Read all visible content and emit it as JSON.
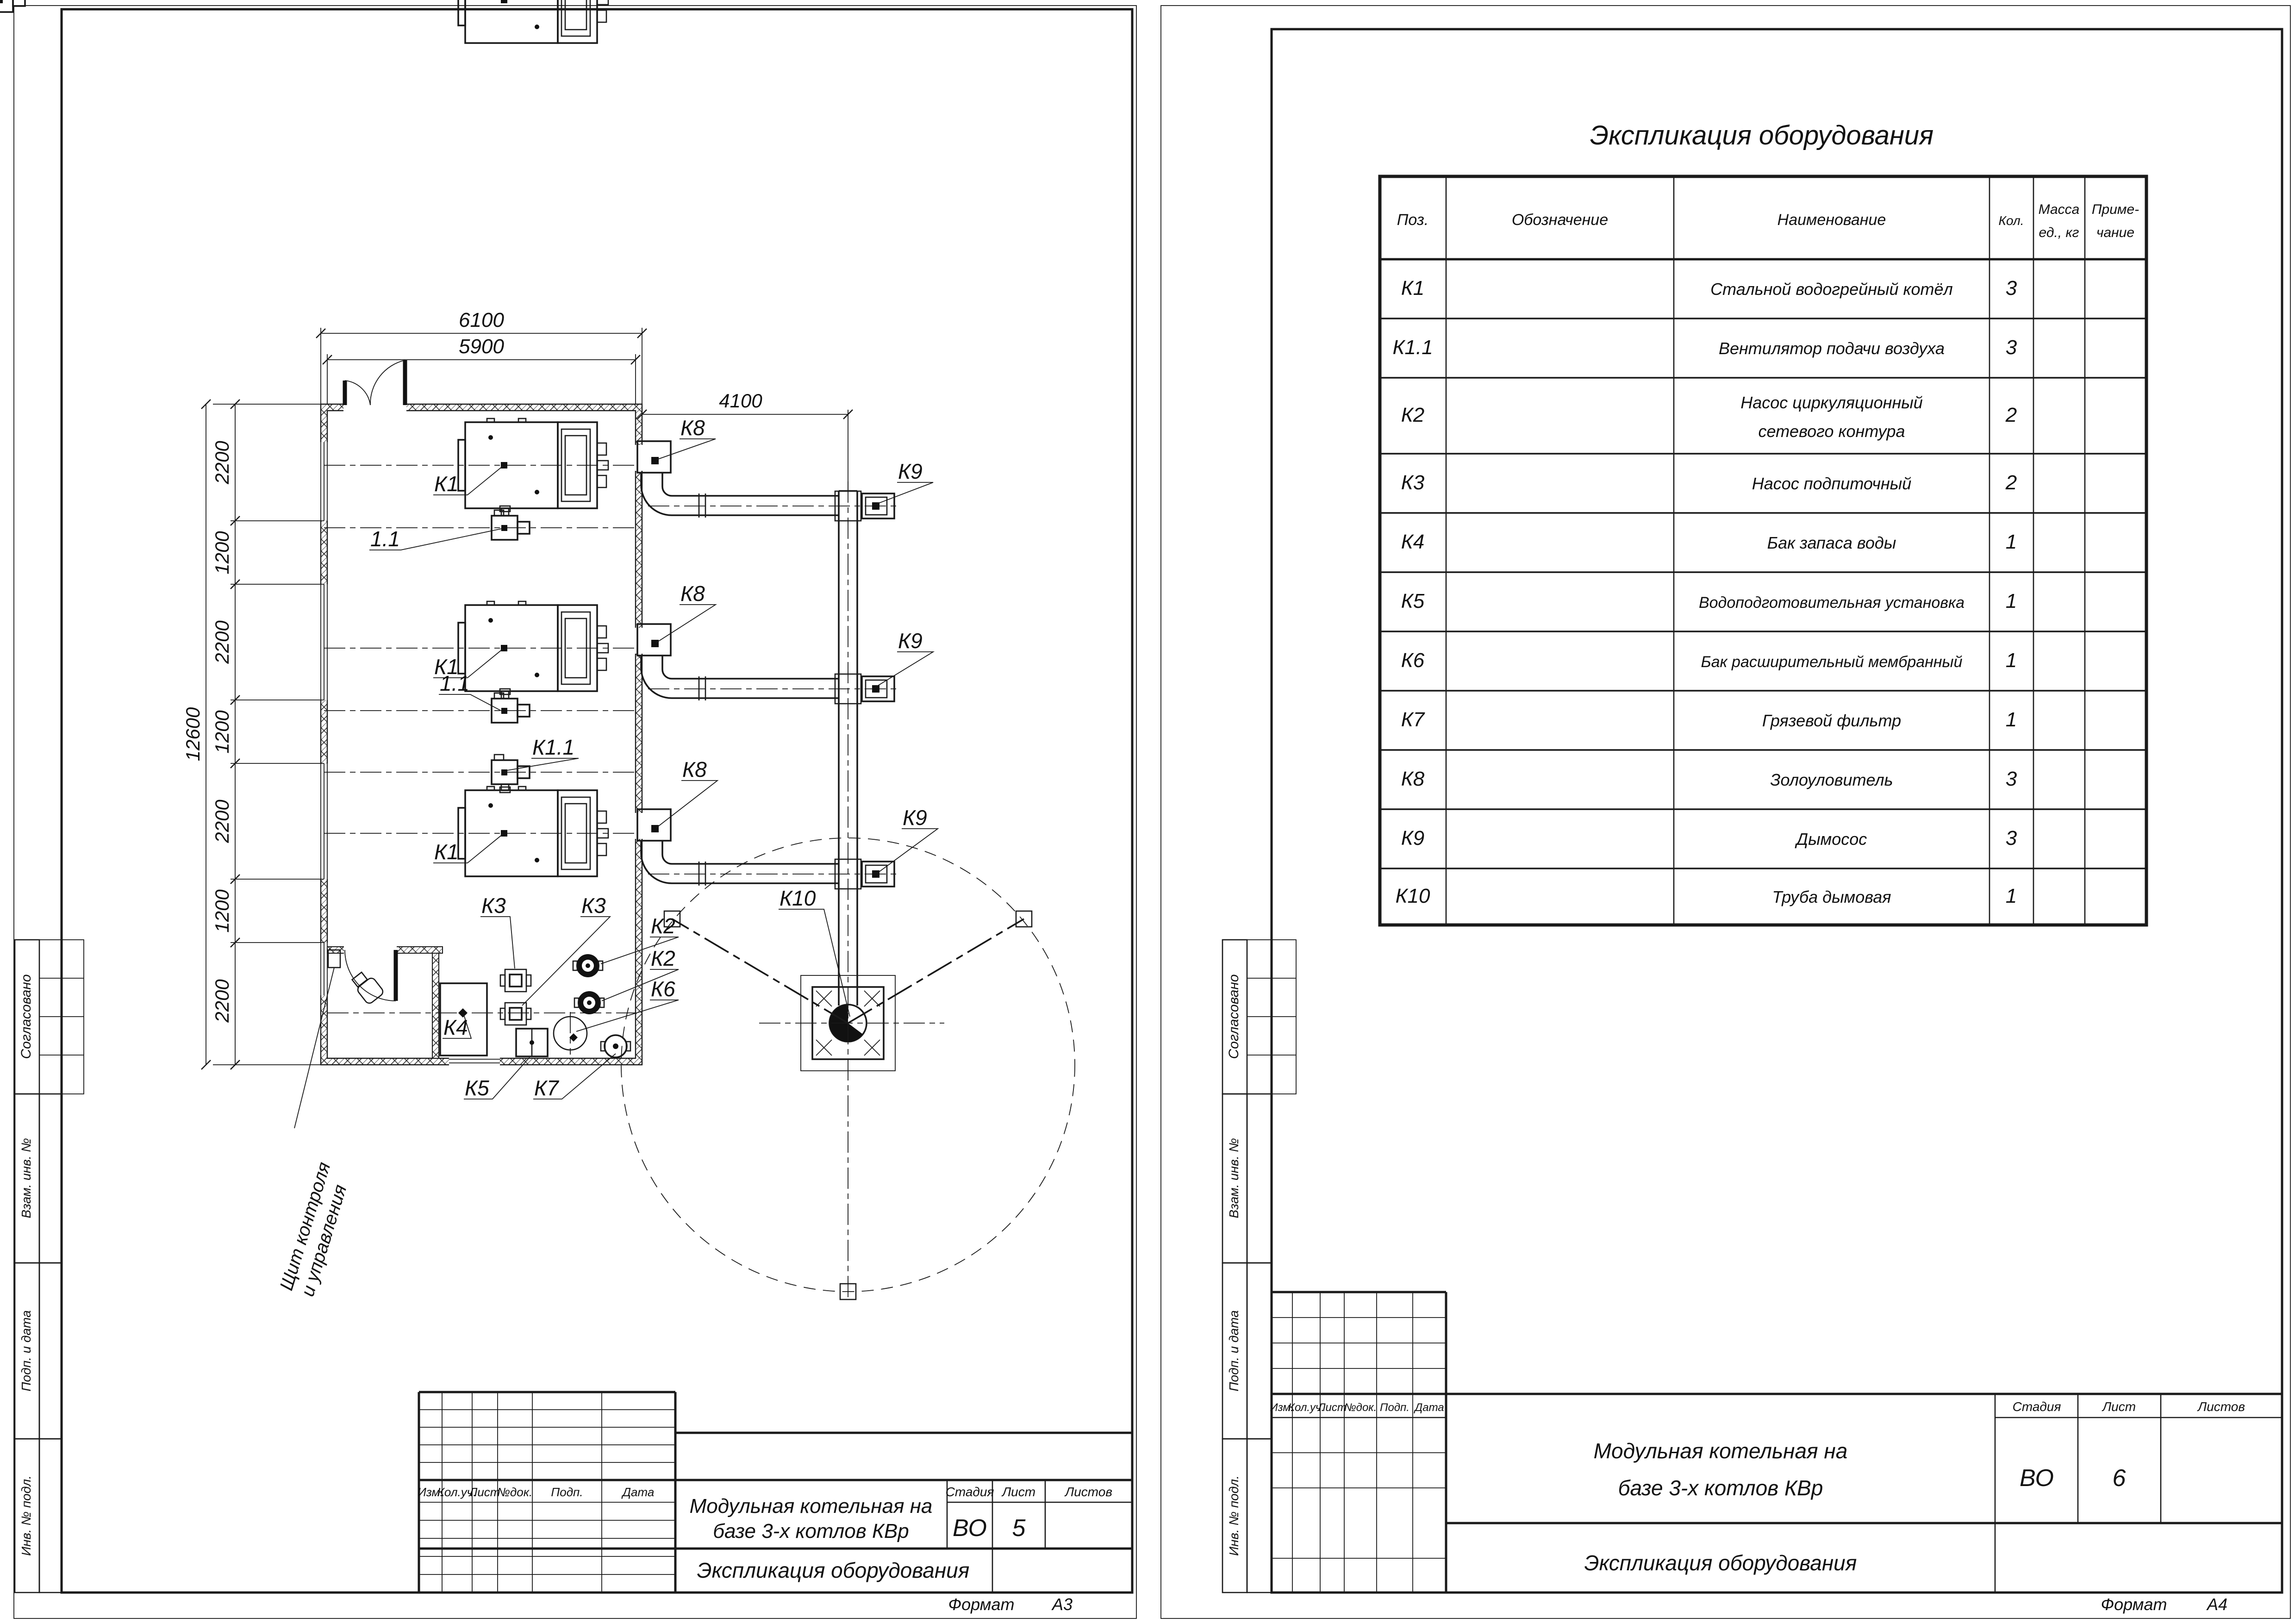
{
  "plan": {
    "dimensions": {
      "width_outer": "6100",
      "width_inner": "5900",
      "flue_offset": "4100",
      "height_total": "12600",
      "height_chain": [
        "2200",
        "1200",
        "2200",
        "1200",
        "2200",
        "1200",
        "2200"
      ]
    },
    "labels": {
      "boiler": "К1",
      "boiler_fan": "1.1",
      "boiler_fan_k": "К1.1",
      "pump_network": "К2",
      "pump_feed": "К3",
      "water_tank": "К4",
      "water_treatment": "К5",
      "expansion_tank": "К6",
      "mud_filter": "К7",
      "ash_catcher": "К8",
      "smoke_exhauster": "К9",
      "chimney": "К10",
      "control_panel_line1": "Щит контроля",
      "control_panel_line2": "и управления"
    }
  },
  "equipment_table": {
    "title": "Экспликация оборудования",
    "headers": {
      "pos": "Поз.",
      "designation": "Обозначение",
      "name": "Наименование",
      "qty": "Кол.",
      "mass_line1": "Масса",
      "mass_line2": "ед., кг",
      "note_line1": "Приме-",
      "note_line2": "чание"
    },
    "rows": [
      {
        "pos": "К1",
        "name": "Стальной водогрейный котёл",
        "name2": "",
        "qty": "3"
      },
      {
        "pos": "К1.1",
        "name": "Вентилятор подачи воздуха",
        "name2": "",
        "qty": "3"
      },
      {
        "pos": "К2",
        "name": "Насос циркуляционный",
        "name2": "сетевого контура",
        "qty": "2"
      },
      {
        "pos": "К3",
        "name": "Насос подпиточный",
        "name2": "",
        "qty": "2"
      },
      {
        "pos": "К4",
        "name": "Бак запаса воды",
        "name2": "",
        "qty": "1"
      },
      {
        "pos": "К5",
        "name": "Водоподготовительная установка",
        "name2": "",
        "qty": "1"
      },
      {
        "pos": "К6",
        "name": "Бак расширительный мембранный",
        "name2": "",
        "qty": "1"
      },
      {
        "pos": "К7",
        "name": "Грязевой фильтр",
        "name2": "",
        "qty": "1"
      },
      {
        "pos": "К8",
        "name": "Золоуловитель",
        "name2": "",
        "qty": "3"
      },
      {
        "pos": "К9",
        "name": "Дымосос",
        "name2": "",
        "qty": "3"
      },
      {
        "pos": "К10",
        "name": "Труба дымовая",
        "name2": "",
        "qty": "1"
      }
    ]
  },
  "title_block": {
    "rev_headers": [
      "Изм.",
      "Кол.уч.",
      "Лист",
      "№док.",
      "Подп.",
      "Дата"
    ],
    "project_line1": "Модульная котельная на",
    "project_line2": "базе 3-х котлов КВр",
    "doc_name": "Экспликация оборудования",
    "stage_label": "Стадия",
    "sheet_label": "Лист",
    "sheets_label": "Листов",
    "stage_value": "ВО",
    "sheet_left": "5",
    "sheet_right": "6",
    "format_label": "Формат",
    "format_left": "А3",
    "format_right": "А4"
  },
  "margin": {
    "approved": "Согласовано",
    "replace_inv": "Взам. инв. №",
    "sign_date": "Подп. и дата",
    "inv_orig": "Инв. № подл."
  }
}
